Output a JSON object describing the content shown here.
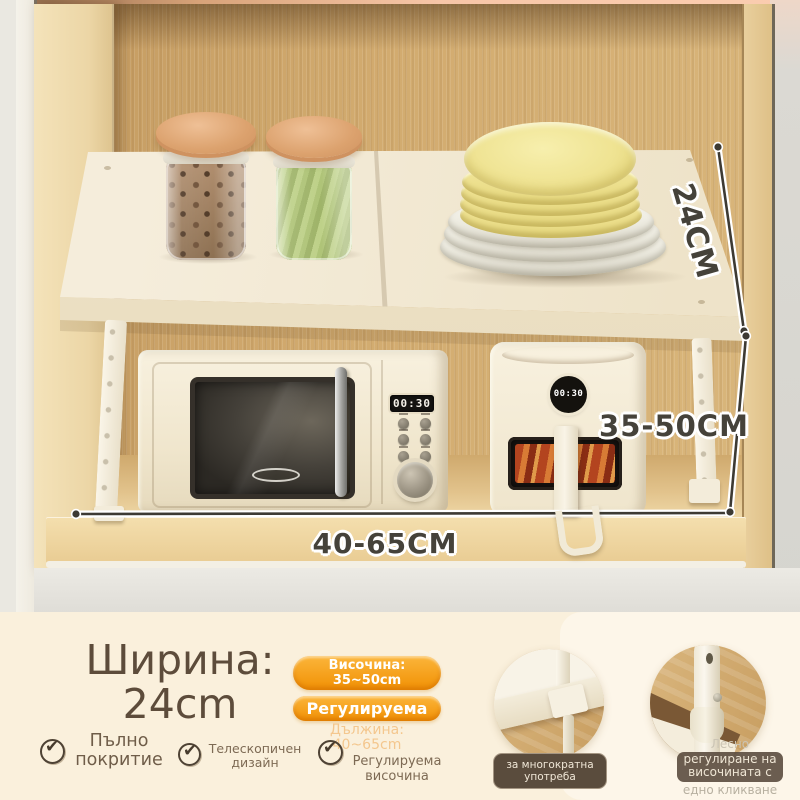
{
  "photo": {
    "dims": {
      "depth": "24CM",
      "height": "35-50CM",
      "width": "40-65CM"
    },
    "microwave": {
      "display": "00:30"
    },
    "airfryer": {
      "display": "00:30"
    }
  },
  "panel": {
    "width_title": {
      "line1": "Ширина:",
      "line2": "24cm"
    },
    "badges": {
      "height": {
        "line1": "Височина:",
        "line2": "35~50cm"
      },
      "adjustable": "Регулируема",
      "length": {
        "line1": "Дължина:",
        "line2": "40~65cm"
      }
    },
    "features": [
      {
        "line1": "Пълно",
        "line2": "покритие"
      },
      {
        "line1": "Телескопичен",
        "line2": "дизайн"
      },
      {
        "line1": "Регулируема",
        "line2": "височина"
      }
    ],
    "detail1_caption": {
      "line1": "за многократна",
      "line2": "употреба"
    },
    "detail2_caption": {
      "line1": "Лесно",
      "line2": "регулиране на",
      "line3": "височината с",
      "line4": "едно кликване"
    }
  },
  "icons": {
    "check": "✔"
  },
  "colors": {
    "accent_orange": "#f29d0e",
    "panel_bg": "#faf0dc",
    "text_brown": "#5d4c3b"
  }
}
